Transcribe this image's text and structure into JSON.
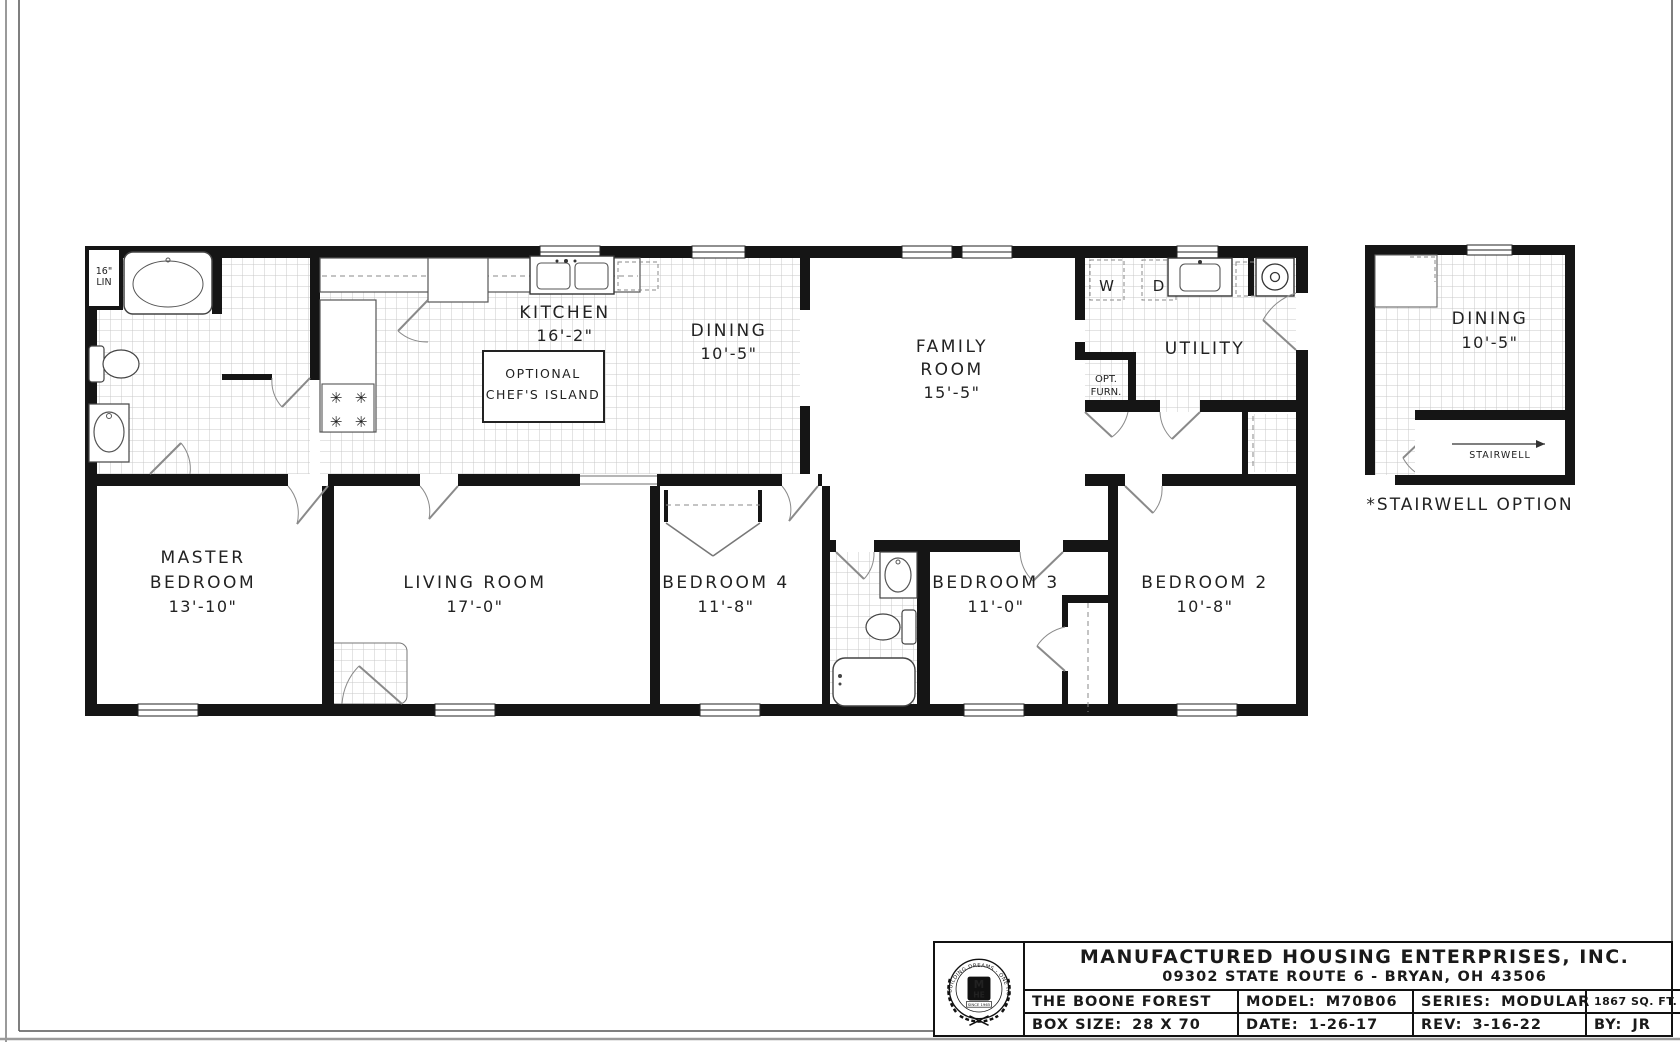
{
  "rooms": {
    "kitchen": {
      "name": "KITCHEN",
      "dim": "16'-2\""
    },
    "dining": {
      "name": "DINING",
      "dim": "10'-5\""
    },
    "family": {
      "line1": "FAMILY",
      "line2": "ROOM",
      "dim": "15'-5\""
    },
    "utility": {
      "name": "UTILITY"
    },
    "master": {
      "line1": "MASTER",
      "line2": "BEDROOM",
      "dim": "13'-10\""
    },
    "living": {
      "name": "LIVING ROOM",
      "dim": "17'-0\""
    },
    "bedroom4": {
      "name": "BEDROOM 4",
      "dim": "11'-8\""
    },
    "bedroom3": {
      "name": "BEDROOM 3",
      "dim": "11'-0\""
    },
    "bedroom2": {
      "name": "BEDROOM 2",
      "dim": "10'-8\""
    }
  },
  "annotations": {
    "island_line1": "OPTIONAL",
    "island_line2": "CHEF'S ISLAND",
    "linen_line1": "16\"",
    "linen_line2": "LIN",
    "washer": "W",
    "dryer": "D",
    "opt_furn_line1": "OPT.",
    "opt_furn_line2": "FURN.",
    "stairwell": "STAIRWELL"
  },
  "stairwell_plan": {
    "dining_name": "DINING",
    "dining_dim": "10'-5\"",
    "caption": "*STAIRWELL OPTION"
  },
  "title_block": {
    "company": "MANUFACTURED HOUSING ENTERPRISES, INC.",
    "address": "09302 STATE ROUTE 6 - BRYAN, OH 43506",
    "plan_name": "THE BOONE FOREST",
    "model_label": "MODEL:",
    "model_value": "M70B06",
    "series_label": "SERIES:",
    "series_value": "MODULAR",
    "sqft": "1867 SQ. FT.",
    "box_label": "BOX SIZE:",
    "box_value": "28 X 70",
    "date_label": "DATE:",
    "date_value": "1-26-17",
    "rev_label": "REV:",
    "rev_value": "3-16-22",
    "by_label": "BY:",
    "by_value": "JR",
    "logo": {
      "ring_text": "BUILDING DREAMS - ONE HOME AT A TIME",
      "monogram_top": "M",
      "monogram_bottom": "HE",
      "since": "SINCE 1965"
    }
  },
  "colors": {
    "wall": "#151515",
    "door": "#8a8a8a",
    "tile": "#c4c4c4",
    "bg": "#ffffff"
  }
}
